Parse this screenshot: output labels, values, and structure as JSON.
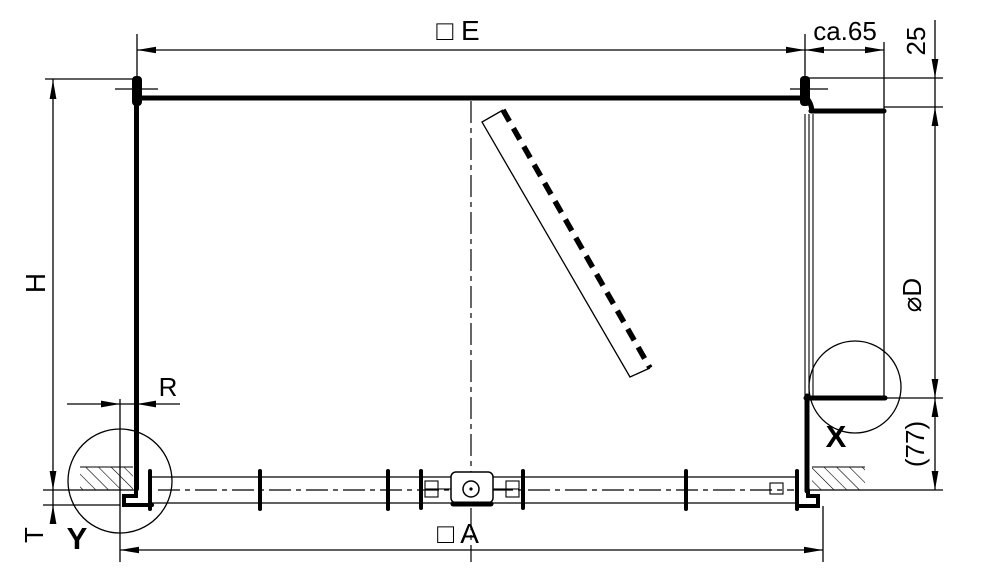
{
  "drawing": {
    "title": "enclosure-section-dimension-drawing",
    "colors": {
      "line": "#000000",
      "background": "#ffffff"
    },
    "dimensions": {
      "outer_width_top": "□ E",
      "overhang": "ca.65",
      "lid_offset": "25",
      "height": "H",
      "flange": "R",
      "diameter": "⌀D",
      "base_offset": "(77)",
      "floor_thickness": "T",
      "outer_width_bottom": "□ A"
    },
    "details": {
      "x_label": "X",
      "y_label": "Y"
    }
  }
}
